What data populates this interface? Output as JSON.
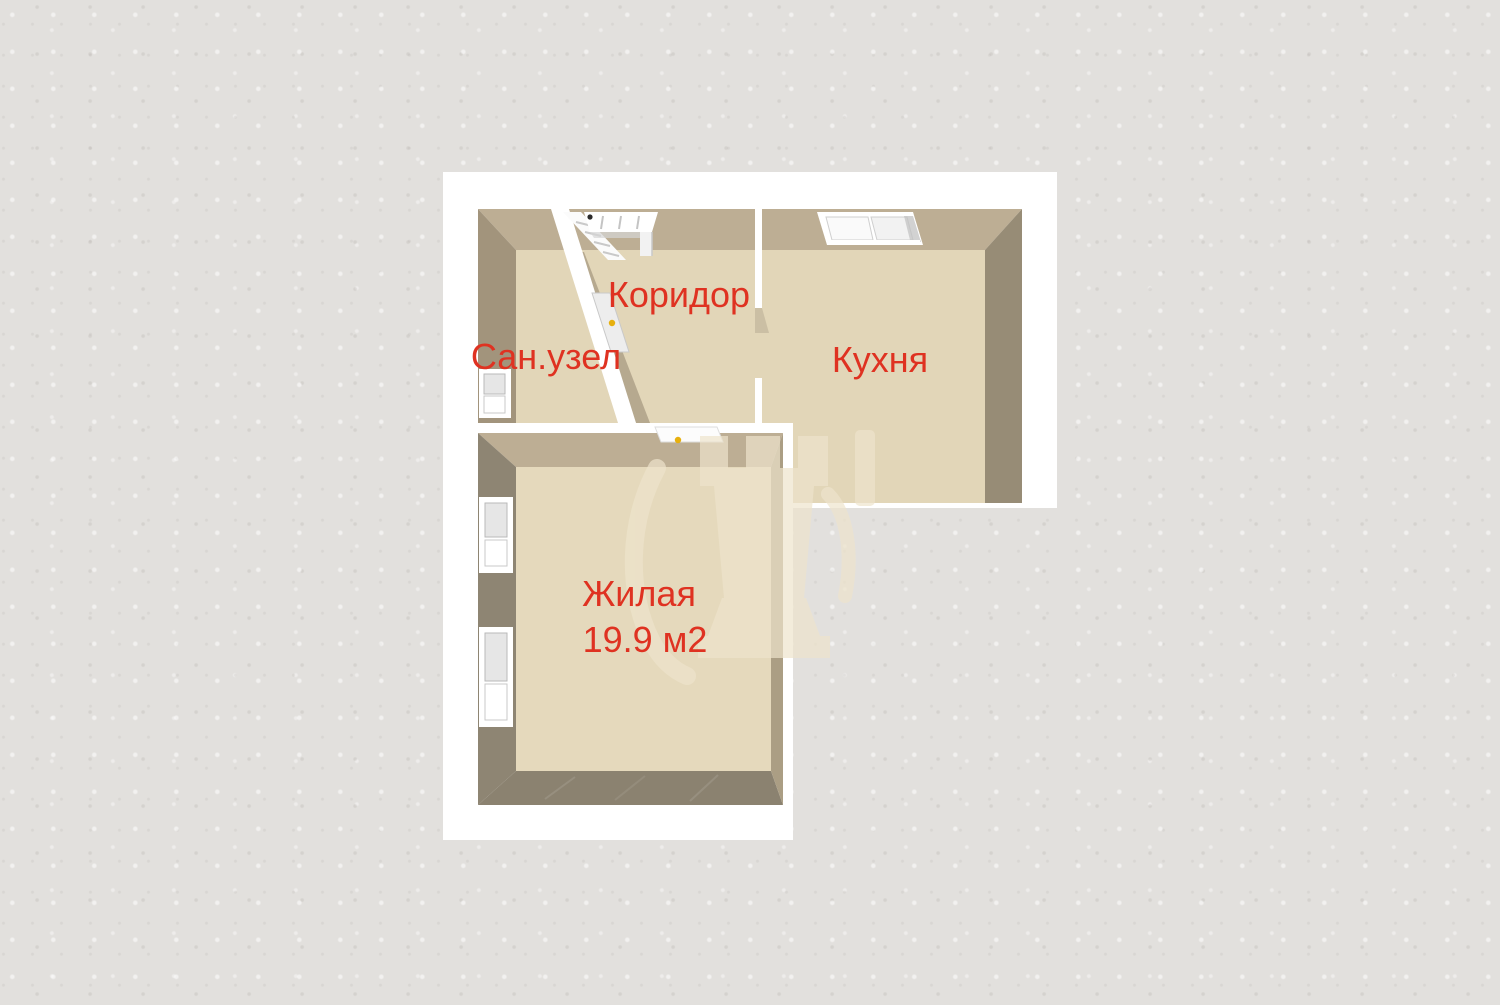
{
  "plan": {
    "type": "apartment-floor-plan-3d",
    "labels": {
      "bathroom": "Сан.узел",
      "corridor": "Коридор",
      "kitchen": "Кухня",
      "living": "Жилая",
      "living_area": "19.9 м2"
    },
    "rooms": [
      {
        "name": "Сан.узел"
      },
      {
        "name": "Коридор"
      },
      {
        "name": "Кухня"
      },
      {
        "name": "Жилая",
        "area": "19.9 м2"
      }
    ]
  },
  "colors": {
    "background": "#e2e0dd",
    "sheet": "#ffffff",
    "wall_top": "#bdae94",
    "wall_left_bath": "#a2947c",
    "wall_right_kitchen": "#978c76",
    "wall_side_dark": "#8e8573",
    "wall_bottom": "#8b8270",
    "wall_face_diag": "#b6a98f",
    "wall_face_living_right": "#ab9e84",
    "door_jamb": "#cbbfa4",
    "floor": "#e2d6b8",
    "floor_living": "#e5d9bc",
    "label_red": "#df3221",
    "door_handle": "#e7b00e",
    "watermark": "#eee4cc"
  }
}
